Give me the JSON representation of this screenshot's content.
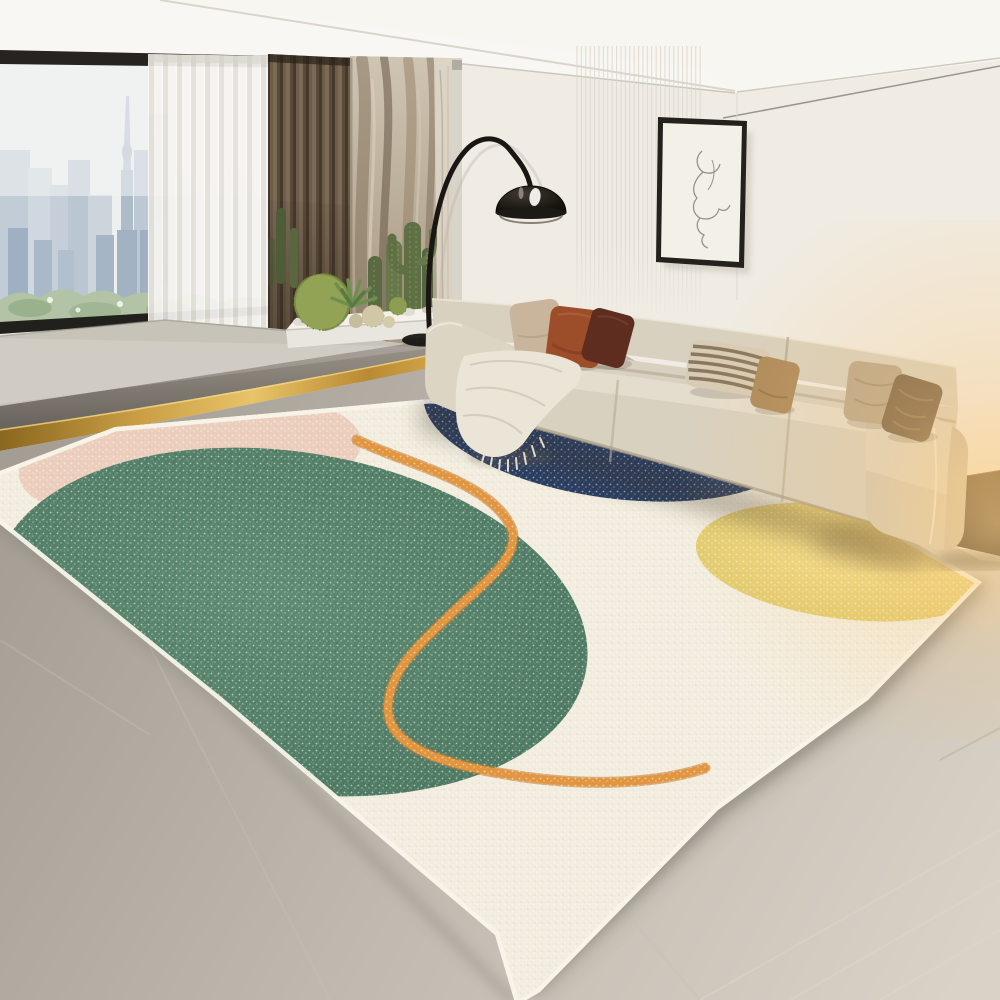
{
  "meta": {
    "title": "Modern living room with abstract speckled area rug, beige modular sofa, black arc floor lamp, cactus planter and city-view window",
    "aria_label": "Photograph of a bright living room: a cream three-seat sofa with earth-tone pillows sits on a large cream rug decorated with a big green circle, a pink circle, a navy half circle, a yellow circle and a wavy orange line. Behind are a floor-to-ceiling window with a city skyline, a white sheer curtain, a brown curtain, a stone feature wall with cacti in a white planter, a black arc floor lamp and a framed one-line face sketch."
  },
  "palette": {
    "wall": "#f0ece4",
    "ceiling": "#f8f6f1",
    "window_sky": "#eef0ef",
    "city_blue": "#a9b8c8",
    "greenery": "#b3c3a6",
    "sheer": "#f4f2ed",
    "curtain_brown": "#6f5e4a",
    "stone": "#c0b3a0",
    "platform": "#c8c3b9",
    "step": "#7f7a72",
    "gold": "#c79e4a",
    "floor": "#b2aca3",
    "floor_light": "#d7d1c6",
    "rug_cream": "#f2edde",
    "rug_pink": "#eccbba",
    "rug_green": "#55806a",
    "rug_navy": "#2b3f63",
    "rug_yellow": "#e9d375",
    "rug_orange": "#e2953f",
    "sofa": "#d8d1c0",
    "sofa_shade": "#c6bda9",
    "pillow_beige": "#c8b59c",
    "pillow_rust": "#9c4e2b",
    "pillow_maroon": "#5e2d1f",
    "pillow_stripe_base": "#d8ccb6",
    "pillow_stripe_line": "#7d6950",
    "pillow_gold": "#ad8a5c",
    "pillow_taupe": "#b9a88e",
    "pillow_brown": "#7c674e",
    "throw": "#eae5d6",
    "lamp_black": "#1b1714",
    "table_brown": "#3c2d1e",
    "frame": "#24211d",
    "canvas": "#f3f0e8",
    "glow": "#ffc46e"
  },
  "scene": {
    "room_elements": [
      "ceiling with angled cove",
      "white back wall with vertical slat panel",
      "floor-to-ceiling window with city skyline and greenery",
      "white sheer curtain",
      "brown pleated curtain",
      "rocky stone feature wall",
      "raised window platform with dark step edge",
      "brass gold floor trim strip",
      "gray stone floor",
      "lighter wood-tone floor at front"
    ],
    "furniture": {
      "sofa": {
        "type": "three-seat modular sofa",
        "color_name": "cream beige",
        "pillows": [
          "beige",
          "rust orange",
          "dark maroon",
          "striped cream-brown",
          "golden tan",
          "taupe",
          "brown velvet"
        ],
        "throw": "cream knit blanket with fringe"
      },
      "side_table": "dark walnut cube table",
      "floor_lamp": "black arc floor lamp with dome shade",
      "wall_art": "single-line face sketch in thin black frame",
      "planter": "white tray with barrel cacti, agave, tall columnar cacti and pebbles"
    },
    "rug": {
      "base": "speckled cream low-pile rug",
      "shapes": [
        {
          "name": "large green circle",
          "position": "left"
        },
        {
          "name": "dusty pink circle",
          "position": "top-left"
        },
        {
          "name": "navy blue half circle",
          "position": "top-center under sofa"
        },
        {
          "name": "yellow circle",
          "position": "right"
        },
        {
          "name": "wavy orange line",
          "position": "center, S-curve"
        }
      ]
    }
  }
}
